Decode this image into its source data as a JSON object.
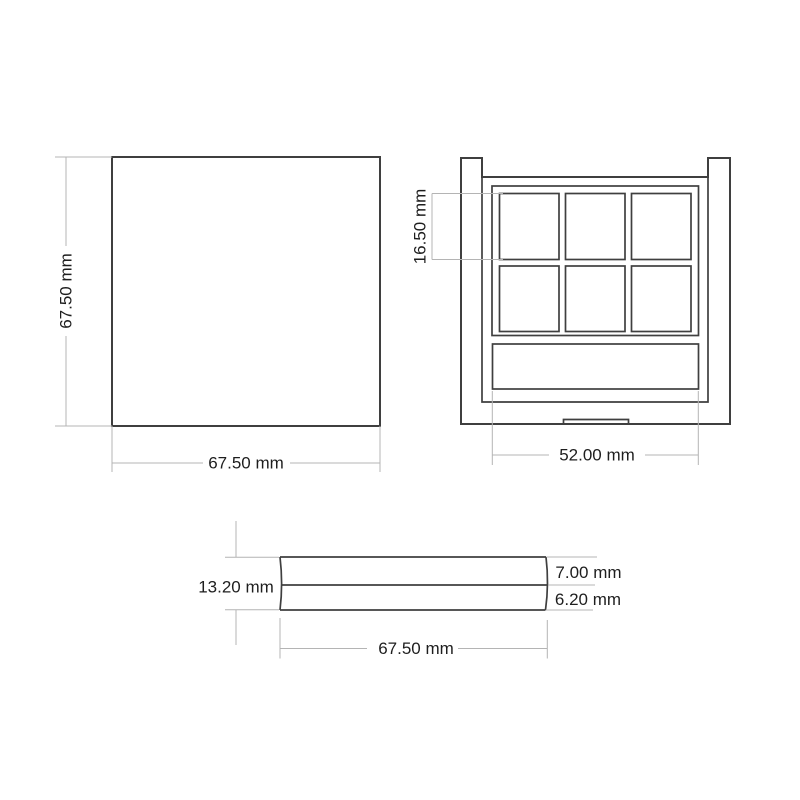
{
  "colors": {
    "bg": "#ffffff",
    "outline": "#3f3f3f",
    "dim": "#b4b4b4",
    "text": "#1e1e1e"
  },
  "views": {
    "lid_top": {
      "height": "67.50 mm",
      "width": "67.50 mm"
    },
    "base_inner": {
      "pan_height": "16.50 mm",
      "tray_width": "52.00 mm",
      "pan_count": 6,
      "pan_grid": "2 x 3"
    },
    "side": {
      "total_height": "13.20 mm",
      "lid_height": "7.00 mm",
      "base_height": "6.20 mm",
      "width": "67.50 mm"
    }
  }
}
